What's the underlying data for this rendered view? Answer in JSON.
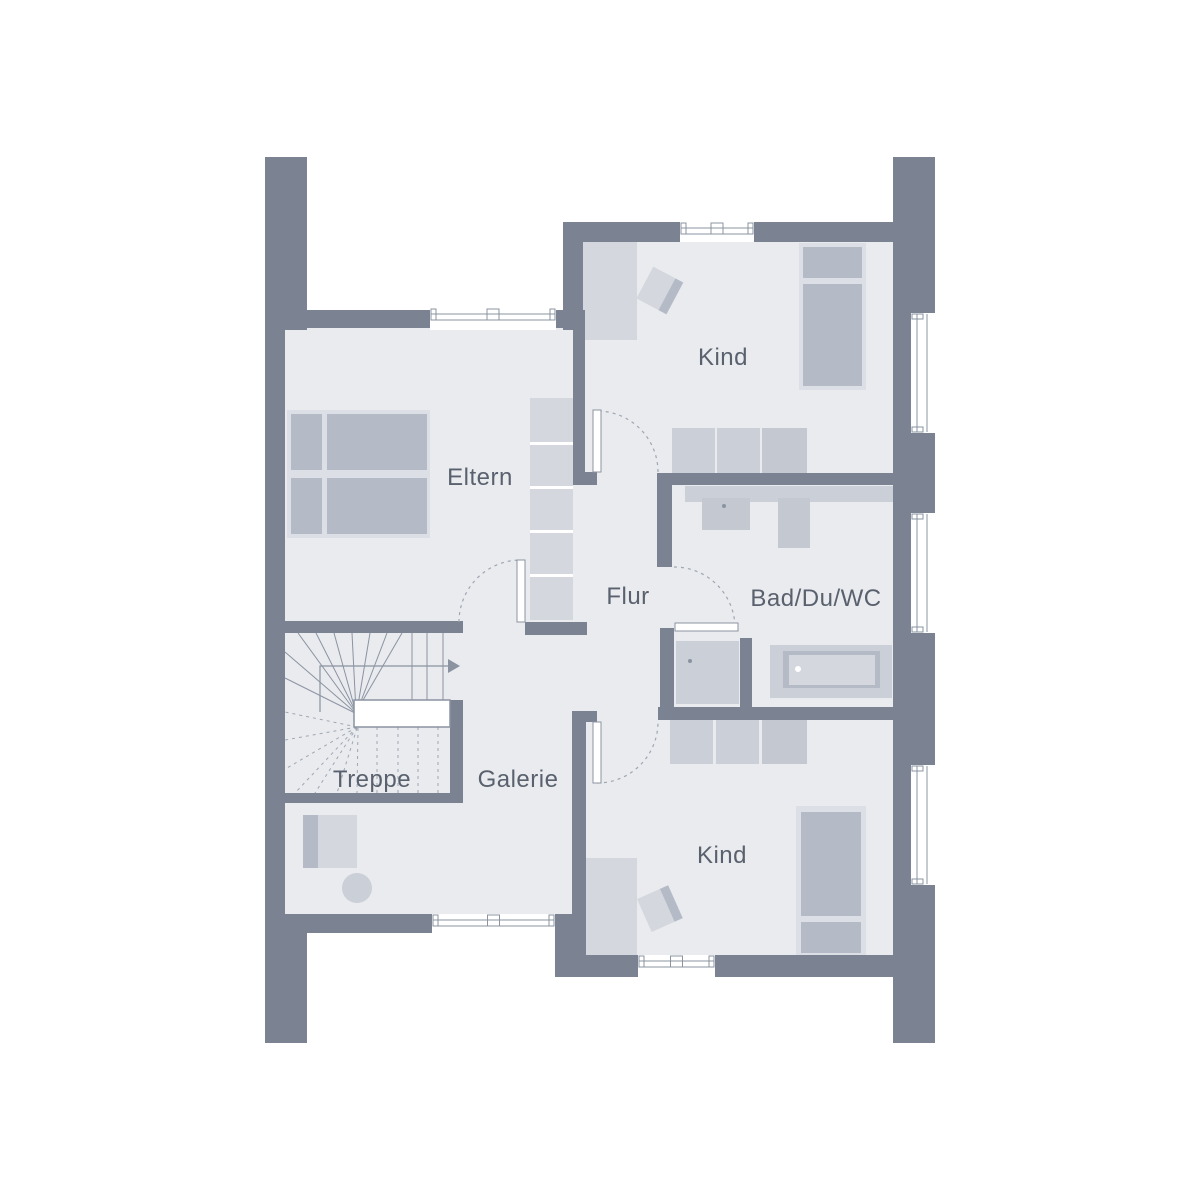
{
  "colors": {
    "background": "#ffffff",
    "wall": "#7b8392",
    "floor": "#e9ebef",
    "furniture_light": "#dcdfe5",
    "furniture_cell": "#d4d7de",
    "furniture_mid": "#cbcfd7",
    "furniture_mid2": "#c3c8d1",
    "furniture_dark": "#b5bbc6",
    "line": "#8b93a1",
    "dash": "#9fa6b2",
    "text": "#5a616e",
    "white": "#ffffff"
  },
  "rooms": [
    {
      "id": "eltern",
      "label": "Eltern",
      "x": 480,
      "y": 485,
      "font": 24
    },
    {
      "id": "kind-top",
      "label": "Kind",
      "x": 723,
      "y": 365,
      "font": 24
    },
    {
      "id": "flur",
      "label": "Flur",
      "x": 628,
      "y": 604,
      "font": 24
    },
    {
      "id": "bad",
      "label": "Bad/Du/WC",
      "x": 816,
      "y": 606,
      "font": 24
    },
    {
      "id": "treppe",
      "label": "Treppe",
      "x": 372,
      "y": 787,
      "font": 24
    },
    {
      "id": "galerie",
      "label": "Galerie",
      "x": 518,
      "y": 787,
      "font": 24
    },
    {
      "id": "kind-bottom",
      "label": "Kind",
      "x": 722,
      "y": 863,
      "font": 24
    }
  ],
  "floors": [
    [
      285,
      310,
      302,
      325
    ],
    [
      583,
      232,
      310,
      253
    ],
    [
      658,
      473,
      235,
      247
    ],
    [
      585,
      473,
      87,
      247
    ],
    [
      285,
      621,
      301,
      312
    ],
    [
      586,
      707,
      307,
      270
    ]
  ],
  "walls": [
    [
      265,
      157,
      42,
      173
    ],
    [
      265,
      310,
      20,
      623
    ],
    [
      265,
      914,
      42,
      129
    ],
    [
      893,
      157,
      42,
      886
    ],
    [
      285,
      310,
      145,
      18
    ],
    [
      556,
      310,
      29,
      18
    ],
    [
      563,
      222,
      20,
      108
    ],
    [
      583,
      222,
      97,
      20
    ],
    [
      754,
      222,
      139,
      20
    ],
    [
      573,
      328,
      12,
      144
    ],
    [
      573,
      472,
      24,
      13
    ],
    [
      657,
      473,
      236,
      12
    ],
    [
      657,
      473,
      15,
      94
    ],
    [
      660,
      628,
      14,
      79
    ],
    [
      658,
      707,
      235,
      13
    ],
    [
      572,
      711,
      25,
      11
    ],
    [
      572,
      722,
      14,
      233
    ],
    [
      740,
      638,
      12,
      69
    ],
    [
      285,
      621,
      178,
      12
    ],
    [
      525,
      622,
      62,
      13
    ],
    [
      450,
      700,
      13,
      103
    ],
    [
      285,
      793,
      178,
      10
    ],
    [
      265,
      914,
      167,
      19
    ],
    [
      555,
      914,
      31,
      63
    ],
    [
      586,
      955,
      52,
      22
    ],
    [
      715,
      955,
      178,
      22
    ]
  ],
  "windows": [
    {
      "x": 430,
      "y": 308,
      "w": 126,
      "h": 22,
      "o": "h"
    },
    {
      "x": 680,
      "y": 222,
      "w": 74,
      "h": 20,
      "o": "h"
    },
    {
      "x": 911,
      "y": 313,
      "w": 24,
      "h": 120,
      "o": "v"
    },
    {
      "x": 911,
      "y": 513,
      "w": 24,
      "h": 120,
      "o": "v"
    },
    {
      "x": 911,
      "y": 765,
      "w": 24,
      "h": 120,
      "o": "v"
    },
    {
      "x": 432,
      "y": 914,
      "w": 123,
      "h": 19,
      "o": "h"
    },
    {
      "x": 638,
      "y": 955,
      "w": 77,
      "h": 22,
      "o": "h"
    }
  ],
  "doors": [
    {
      "id": "door-eltern",
      "leaf": [
        517,
        560,
        8,
        62
      ],
      "arc": "M 459 622 A 62 62 0 0 1 521 560"
    },
    {
      "id": "door-kind-top",
      "leaf": [
        593,
        410,
        8,
        62
      ],
      "arc": "M 658 472 A 61 61 0 0 0 597 411"
    },
    {
      "id": "door-kind-bottom",
      "leaf": [
        593,
        722,
        8,
        61
      ],
      "arc": "M 597 783 A 61 61 0 0 0 658 722"
    },
    {
      "id": "door-bad",
      "leaf": [
        675,
        623,
        63,
        8
      ],
      "arc": "M 674 567 A 61 61 0 0 1 735 628"
    }
  ],
  "stairs": {
    "landing": [
      354,
      700,
      96,
      27
    ],
    "arrow_path": "M 320 712 L 320 666 L 448 666",
    "arrow_head": "448,659 460,666 448,673",
    "solid": [
      [
        357,
        714,
        285,
        652
      ],
      [
        357,
        714,
        285,
        678
      ],
      [
        357,
        714,
        298,
        633
      ],
      [
        357,
        714,
        316,
        633
      ],
      [
        356,
        713,
        334,
        633
      ],
      [
        356,
        712,
        352,
        633
      ],
      [
        357,
        711,
        370,
        633
      ],
      [
        358,
        709,
        387,
        633
      ],
      [
        359,
        707,
        402,
        633
      ],
      [
        412,
        633,
        412,
        700
      ],
      [
        427,
        633,
        427,
        700
      ],
      [
        443,
        633,
        443,
        700
      ]
    ],
    "dashed": [
      [
        357,
        727,
        285,
        712
      ],
      [
        357,
        727,
        285,
        740
      ],
      [
        357,
        727,
        287,
        768
      ],
      [
        357,
        727,
        295,
        793
      ],
      [
        357,
        727,
        315,
        793
      ],
      [
        357,
        728,
        337,
        793
      ],
      [
        358,
        728,
        357,
        793
      ],
      [
        377,
        727,
        377,
        793
      ],
      [
        398,
        727,
        398,
        793
      ],
      [
        418,
        727,
        418,
        793
      ],
      [
        438,
        727,
        438,
        793
      ]
    ]
  },
  "furniture": {
    "light": [
      [
        287,
        410,
        143,
        128
      ],
      [
        799,
        243,
        67,
        147
      ],
      [
        796,
        806,
        70,
        149
      ]
    ],
    "mid": [
      [
        672,
        428,
        43,
        45
      ],
      [
        717,
        428,
        43,
        45
      ],
      [
        685,
        486,
        208,
        16
      ],
      [
        676,
        641,
        63,
        63
      ],
      [
        770,
        645,
        122,
        53
      ],
      [
        670,
        720,
        43,
        44
      ],
      [
        716,
        720,
        43,
        44
      ]
    ],
    "mid2": [
      [
        762,
        428,
        45,
        45
      ],
      [
        702,
        498,
        48,
        32
      ],
      [
        778,
        498,
        32,
        50
      ],
      [
        762,
        720,
        45,
        44
      ]
    ],
    "dark": [
      [
        291,
        414,
        31,
        56
      ],
      [
        291,
        478,
        31,
        56
      ],
      [
        327,
        414,
        100,
        56
      ],
      [
        327,
        478,
        100,
        56
      ],
      [
        803,
        247,
        59,
        31
      ],
      [
        803,
        284,
        59,
        102
      ],
      [
        783,
        651,
        97,
        37
      ],
      [
        801,
        812,
        60,
        104
      ],
      [
        801,
        922,
        60,
        31
      ],
      [
        303,
        815,
        15,
        53
      ]
    ],
    "cell": [
      [
        530,
        398,
        43,
        222
      ],
      [
        583,
        242,
        54,
        98
      ],
      [
        789,
        655,
        86,
        30
      ],
      [
        586,
        858,
        51,
        97
      ],
      [
        318,
        815,
        39,
        53
      ]
    ],
    "white_gaps": [
      [
        530,
        442,
        43,
        3
      ],
      [
        530,
        486,
        43,
        3
      ],
      [
        530,
        530,
        43,
        3
      ],
      [
        530,
        574,
        43,
        3
      ]
    ],
    "chairs": [
      {
        "cx": 659,
        "cy": 290,
        "rot": 28
      },
      {
        "cx": 659,
        "cy": 909,
        "rot": -24
      }
    ],
    "circles": [
      {
        "cx": 357,
        "cy": 888,
        "r": 15,
        "fill": "mid"
      }
    ],
    "dots": [
      {
        "cx": 724,
        "cy": 506,
        "r": 2,
        "fill": "line"
      },
      {
        "cx": 690,
        "cy": 661,
        "r": 2,
        "fill": "line"
      },
      {
        "cx": 798,
        "cy": 669,
        "r": 3,
        "fill": "white"
      }
    ]
  }
}
